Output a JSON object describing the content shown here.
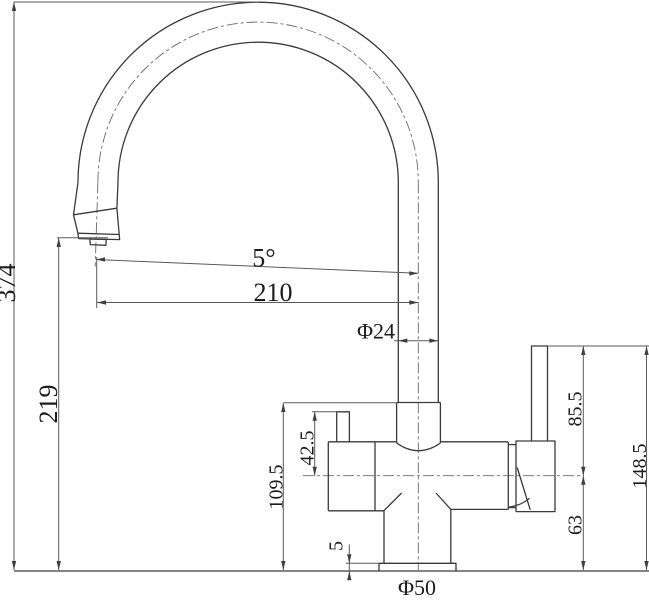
{
  "drawing": {
    "type": "technical-dimension-drawing",
    "subject": "kitchen-faucet-side-view",
    "background_color": "#ffffff",
    "outline_color": "#3a3a3a",
    "dimension_line_color": "#5a5a5a",
    "centerline_color": "#6a6a6a",
    "text_color": "#1c1c1c"
  },
  "dimensions": {
    "overall_height": "374",
    "spout_outlet_height": "219",
    "spout_reach": "210",
    "spout_angle": "5°",
    "spout_pipe_diameter": "Φ24",
    "inlet_to_center": "42.5",
    "body_top_height": "109.5",
    "base_plate_thickness": "5",
    "base_diameter": "Φ50",
    "handle_top_to_center": "85.5",
    "center_to_base": "63",
    "handle_overall_height": "148.5"
  }
}
